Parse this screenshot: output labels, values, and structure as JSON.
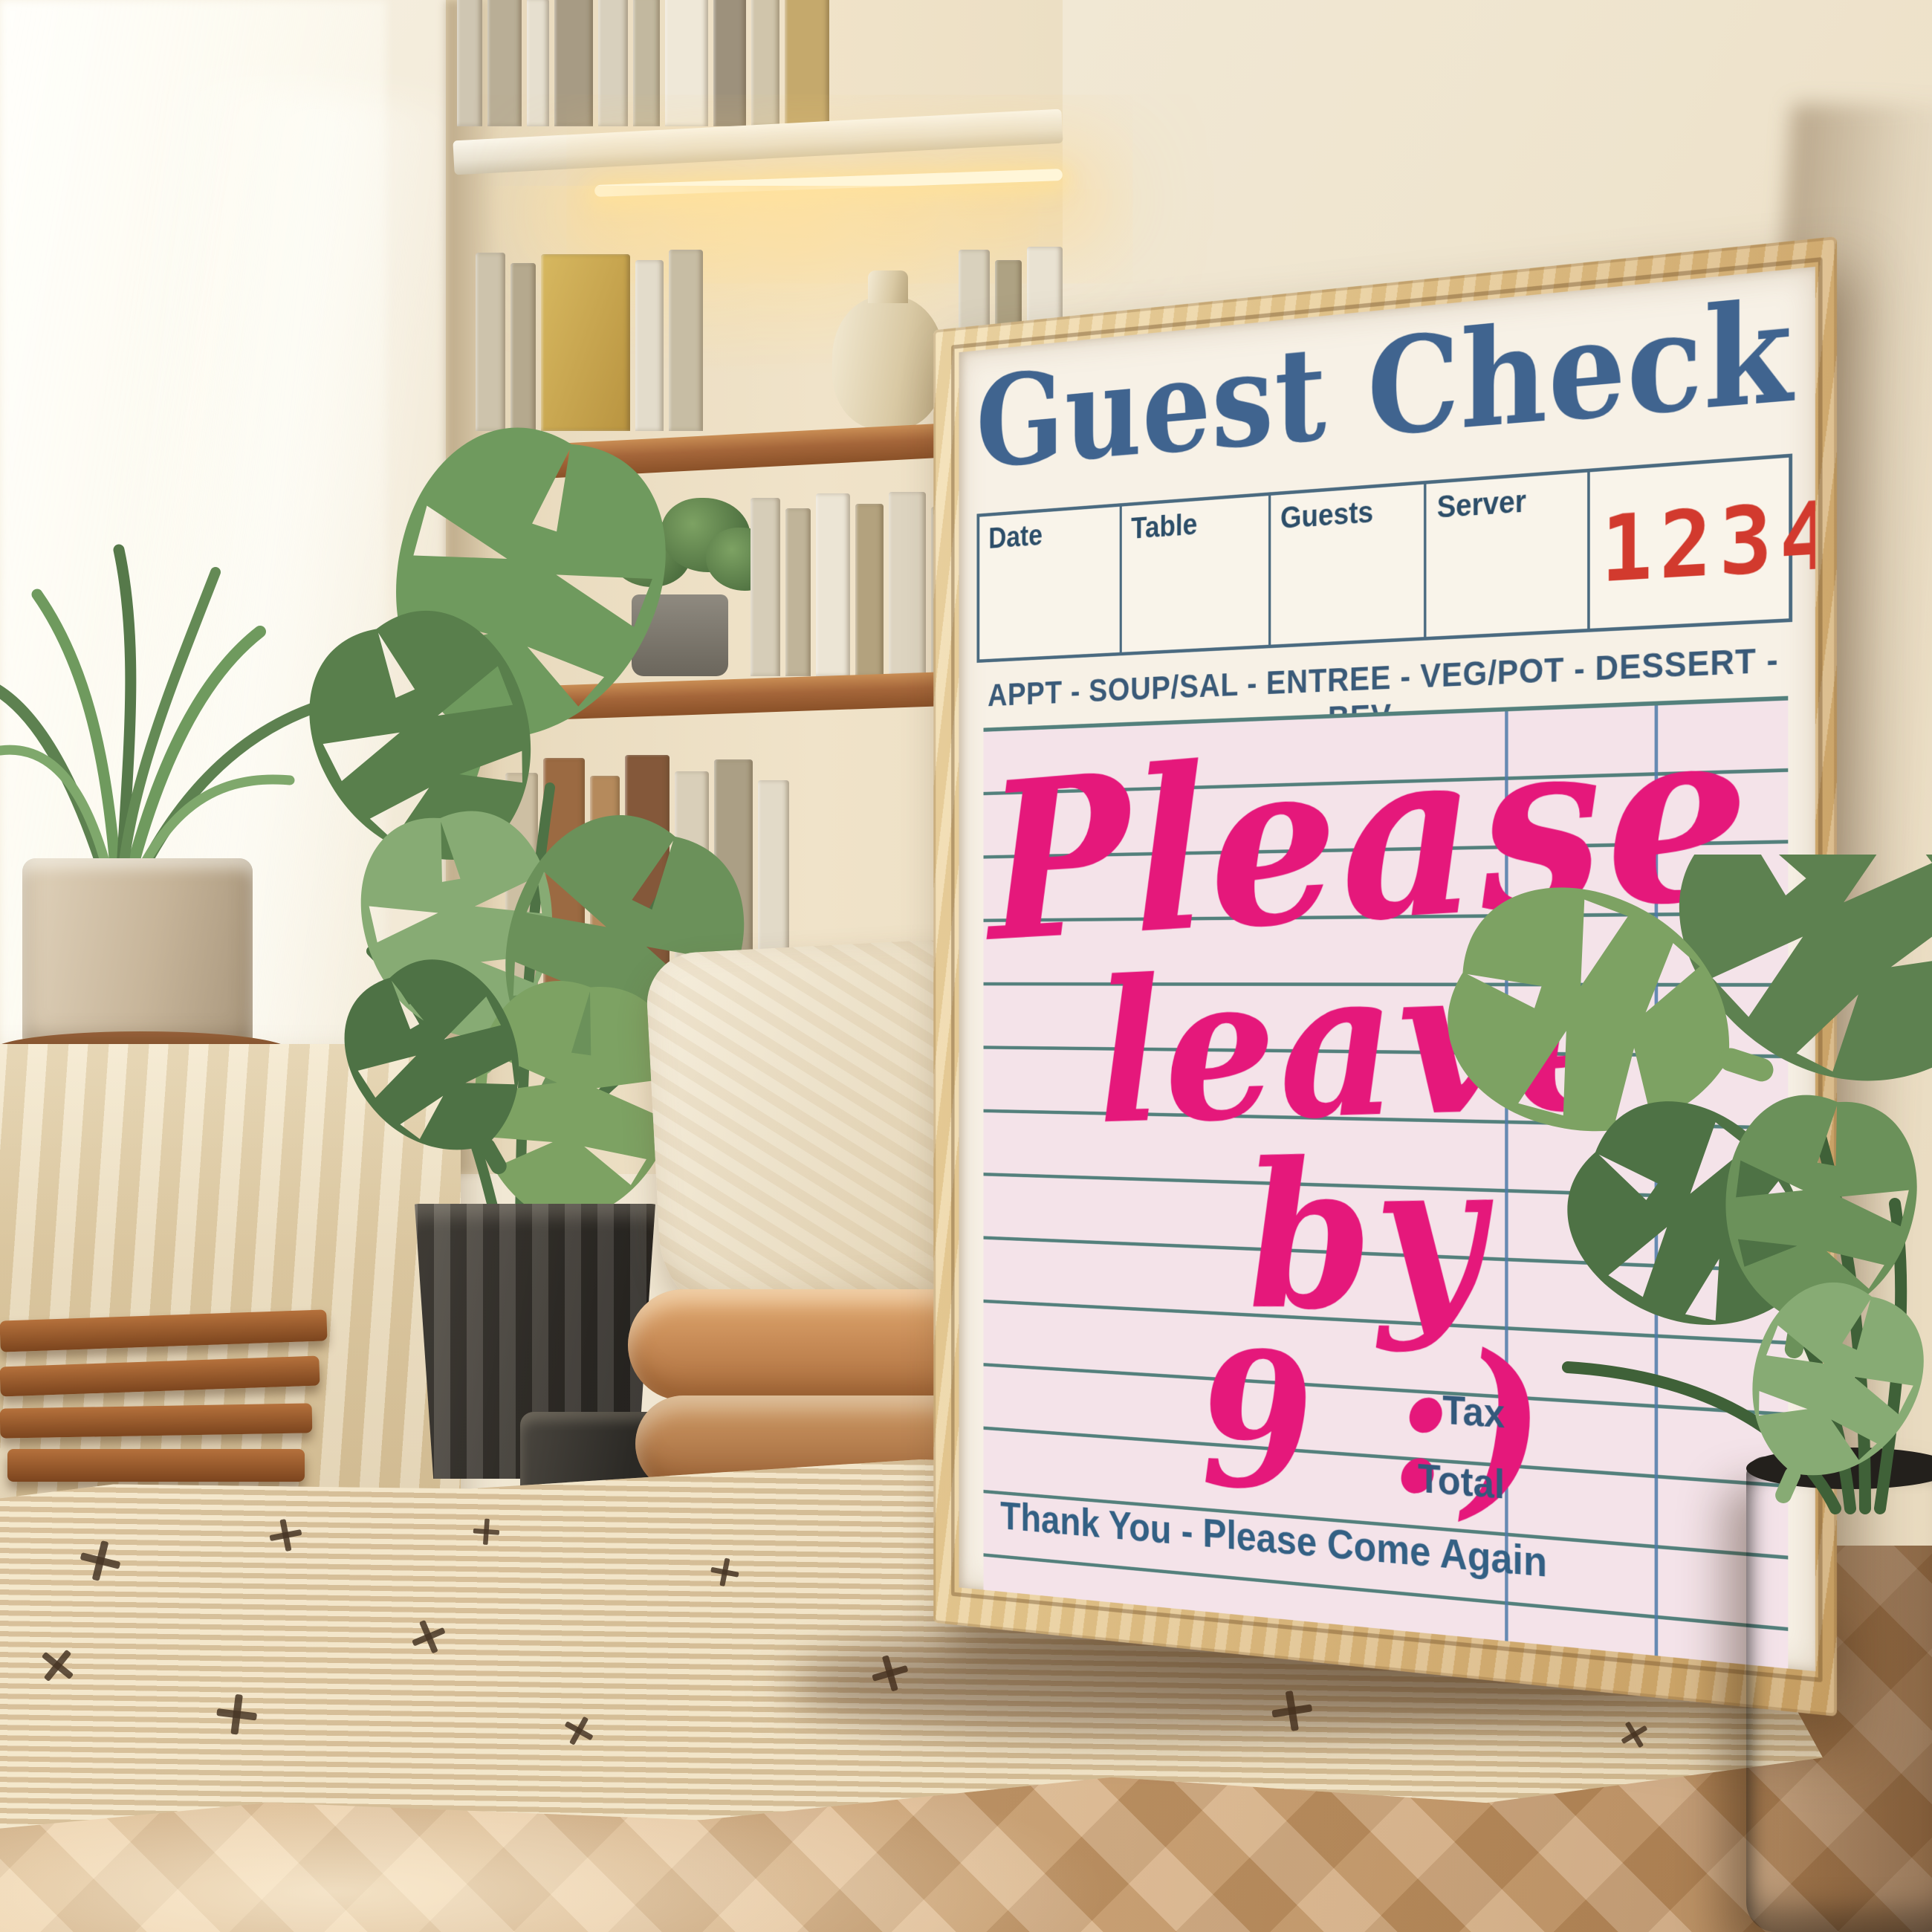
{
  "poster": {
    "title": "Guest Check",
    "header_fields": [
      "Date",
      "Table",
      "Guests",
      "Server"
    ],
    "check_number": "123456",
    "categories_line": "APPT - SOUP/SAL - ENTREE - VEG/POT - DESSERT - BEV",
    "handwritten_note": {
      "line1": "Please",
      "line2": "leave by",
      "line3": "9 :)"
    },
    "tax_label": "Tax",
    "total_label": "Total",
    "footer_message": "Thank You - Please Come Again",
    "colors": {
      "title_blue": "#40648f",
      "check_number_red": "#d23a2e",
      "note_pink": "#e5187b",
      "rule_teal": "#53807c",
      "column_rule_blue": "#4d7aa8",
      "label_slate": "#2d4e69",
      "paper_cream": "#f7f1e6",
      "paper_pink": "#f4e3e9",
      "frame_wood": "#e0bd85"
    }
  }
}
